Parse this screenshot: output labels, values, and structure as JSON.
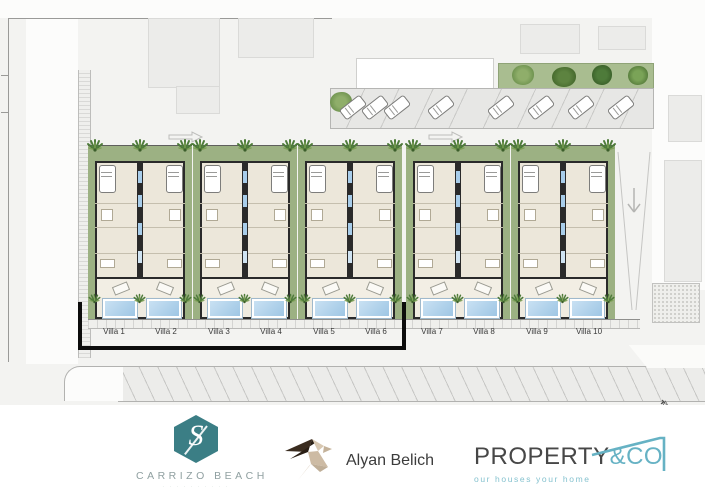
{
  "plan": {
    "villa_labels": [
      "Villa 1",
      "Villa 2",
      "Villa 3",
      "Villa 4",
      "Villa 5",
      "Villa 6",
      "Villa 7",
      "Villa 8",
      "Villa 9",
      "Villa 10"
    ],
    "compass": "N"
  },
  "branding": {
    "carrizo": {
      "monogram": "S",
      "name": "CARRIZO BEACH",
      "subtext": "· · · · · · · · · ·"
    },
    "alyan": {
      "name": "Alyan Belich"
    },
    "property": {
      "name": "PROPERTY",
      "suffix": "&CO",
      "tagline": "our houses your home"
    }
  },
  "colors": {
    "carrizo_teal": "#3b7e85",
    "property_teal": "#66b2c4",
    "garden_green": "#9cb183",
    "pool_blue": "#b7d8ef",
    "boundary_black": "#0c0c0c"
  }
}
